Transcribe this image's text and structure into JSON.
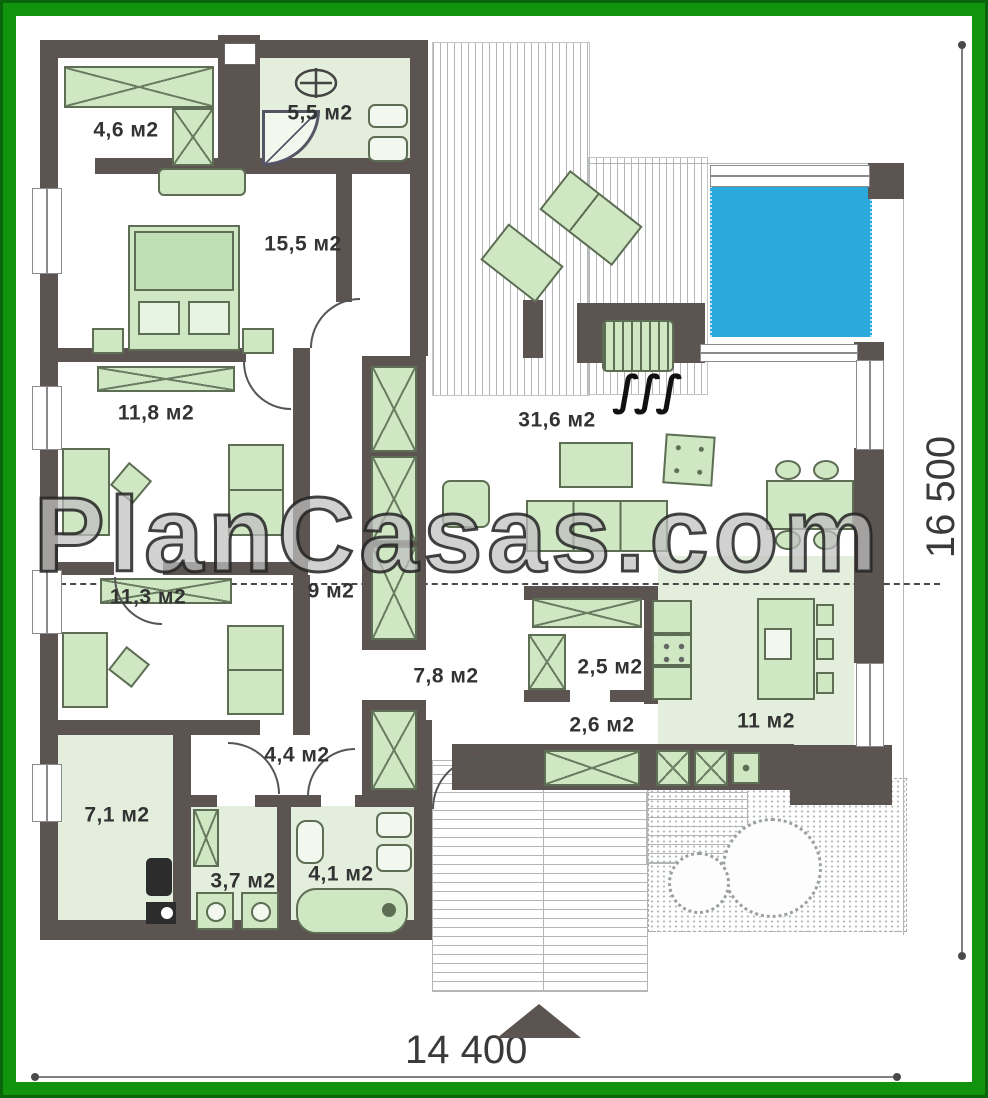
{
  "watermark": "PlanCasas.com",
  "dimensions": {
    "width_label": "14 400",
    "height_label": "16 500"
  },
  "rooms": {
    "closet": "4,6 м2",
    "entry": "5,5 м2",
    "bedroom_master": "15,5 м2",
    "bedroom_2": "11,8 м2",
    "living": "31,6 м2",
    "bedroom_3": "11,3 м2",
    "wardrobe_hall": "9 м2",
    "corridor": "7,8 м2",
    "pantry": "2,5 м2",
    "pantry_hall": "2,6 м2",
    "kitchen": "11 м2",
    "utility": "7,1 м2",
    "hallway": "4,4 м2",
    "wc": "3,7 м2",
    "bathroom": "4,1 м2"
  },
  "icons": {
    "heat_waves": "∫∫∫"
  },
  "colors": {
    "frame_green": "#12930e",
    "wall": "#5b5450",
    "furniture_fill": "#cfe8c3",
    "furniture_line": "#5d6e55",
    "floor_tint": "#e4eedc",
    "pool_blue": "#2ba9dc",
    "hatch_gray": "#b2b6b6",
    "label_text": "#333333"
  }
}
